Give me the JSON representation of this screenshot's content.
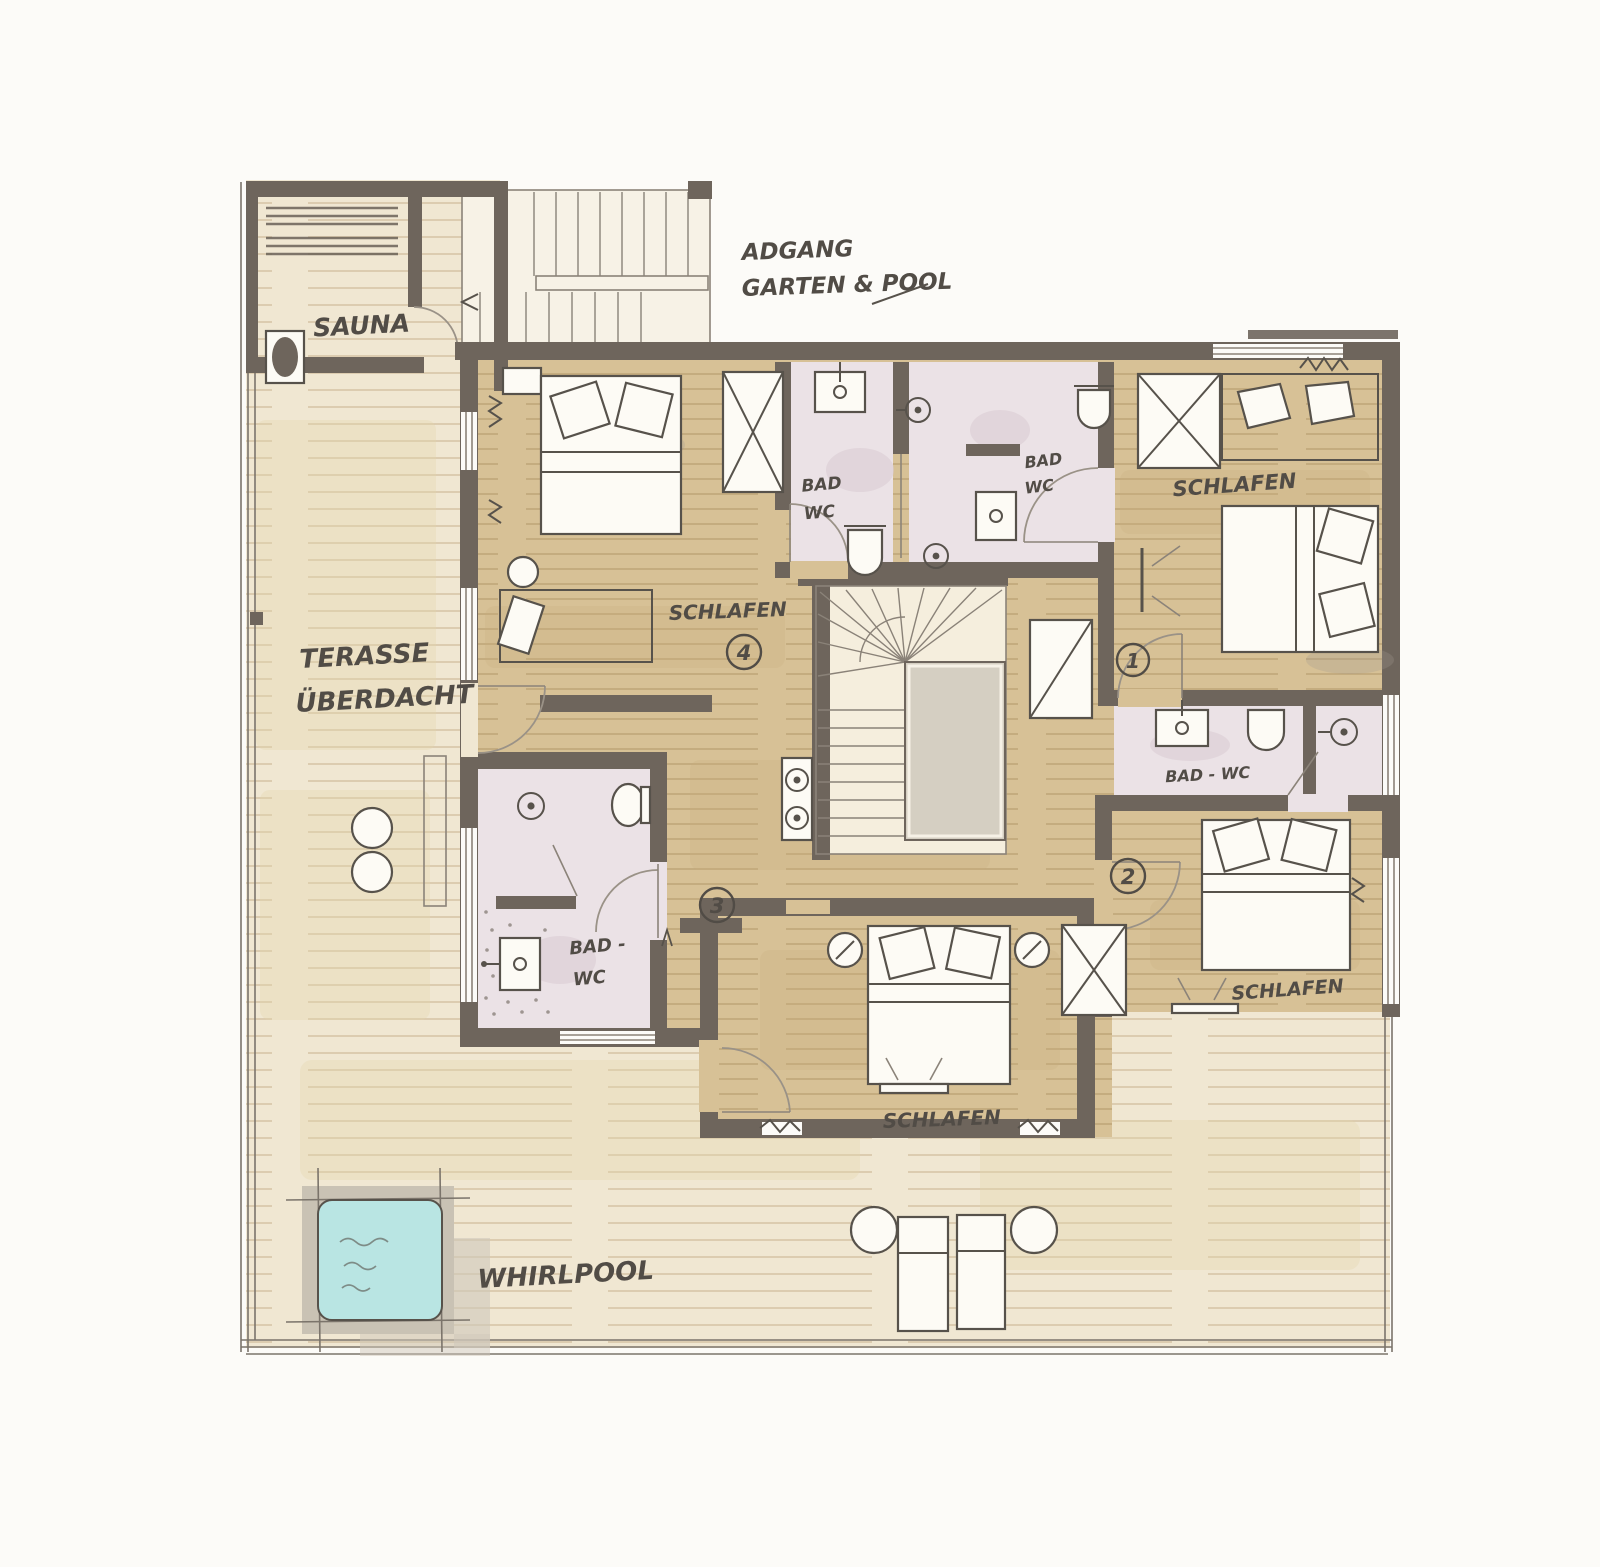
{
  "plan": {
    "rooms": {
      "sauna": {
        "label": "SAUNA"
      },
      "access": {
        "line1": "ADGANG",
        "line2": "GARTEN & POOL"
      },
      "terrace": {
        "line1": "TERASSE",
        "line2": "ÜBERDACHT"
      },
      "whirlpool": {
        "label": "WHIRLPOOL"
      },
      "bedroom1": {
        "label": "SCHLAFEN",
        "number": "1"
      },
      "bedroom2": {
        "label": "SCHLAFEN",
        "number": "2"
      },
      "bedroom3": {
        "label": "SCHLAFEN",
        "number": "3"
      },
      "bedroom4": {
        "label": "SCHLAFEN",
        "number": "4"
      },
      "bath_top_left": {
        "line1": "BAD",
        "line2": "WC"
      },
      "bath_top_right": {
        "line1": "BAD",
        "line2": "WC"
      },
      "bath_right": {
        "label": "BAD - WC"
      },
      "bath_bottom_left": {
        "line1": "BAD -",
        "line2": "WC"
      }
    },
    "colors": {
      "paper": "#fcfbf8",
      "wall": "#6e655c",
      "wood": "#d7c196",
      "deck": "#f0e7d2",
      "bath": "#ebe2e6",
      "pool": "#b9e5e3",
      "ink": "#57524b",
      "streak": "#c9ad7d",
      "deckstreak": "#e4d3a9",
      "stairfloor": "#f5eedd",
      "core": "#d5cfc2"
    }
  }
}
